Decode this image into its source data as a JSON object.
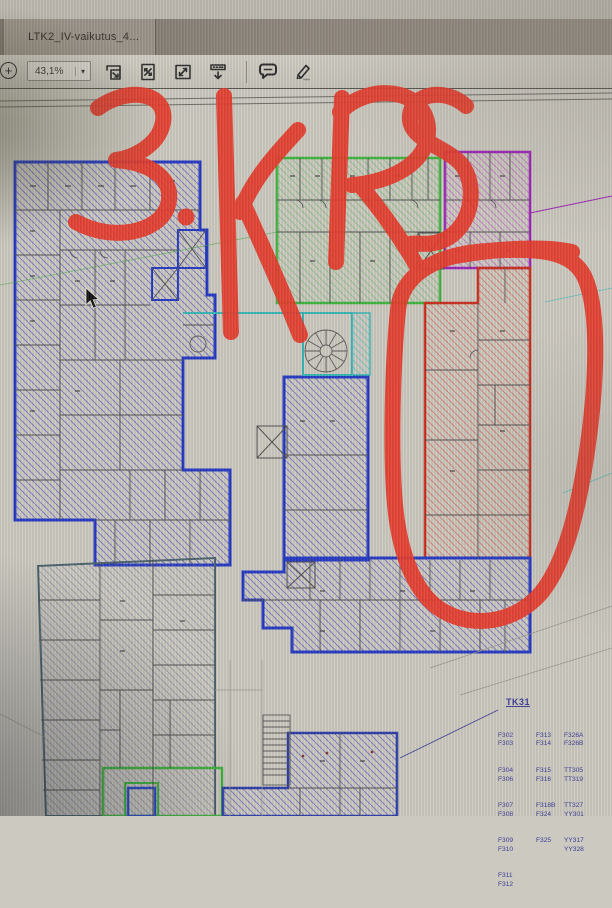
{
  "window": {
    "tab_title": "LTK2_IV-vaikutus_4..."
  },
  "toolbar": {
    "zoom_in_label": "+",
    "zoom_value": "43,1%",
    "dropdown_caret": "▾",
    "icons": [
      "scale-page",
      "fit-page",
      "fit-width",
      "hide-toolbar",
      "comment",
      "highlight"
    ]
  },
  "annotations": {
    "marker_text": "3.KRS",
    "marker_color": "#e6392a",
    "circled_region": "red wing (right side of plan)"
  },
  "plan": {
    "colors": {
      "blue": "#2438c4",
      "green": "#3cb43c",
      "purple": "#9c22b8",
      "red": "#c92c1c",
      "teal": "#35b6b6",
      "navy": "#2a3ba8",
      "grayline": "#49626d",
      "walls": "#4f4f4f",
      "legend": "#3c3c96"
    },
    "legend": {
      "title": "TK31",
      "col1": [
        "F302",
        "F303",
        "F304",
        "F306",
        "F307",
        "F308",
        "F309",
        "F310",
        "F311",
        "F312"
      ],
      "col2": [
        "F313",
        "F314",
        "F315",
        "F316",
        "F318B",
        "F324",
        "F325"
      ],
      "col3": [
        "F326A",
        "F326B",
        "TT305",
        "TT319",
        "TT327",
        "YY301",
        "YY317",
        "YY328"
      ]
    }
  },
  "cursor": {
    "x": 86,
    "y": 288
  }
}
